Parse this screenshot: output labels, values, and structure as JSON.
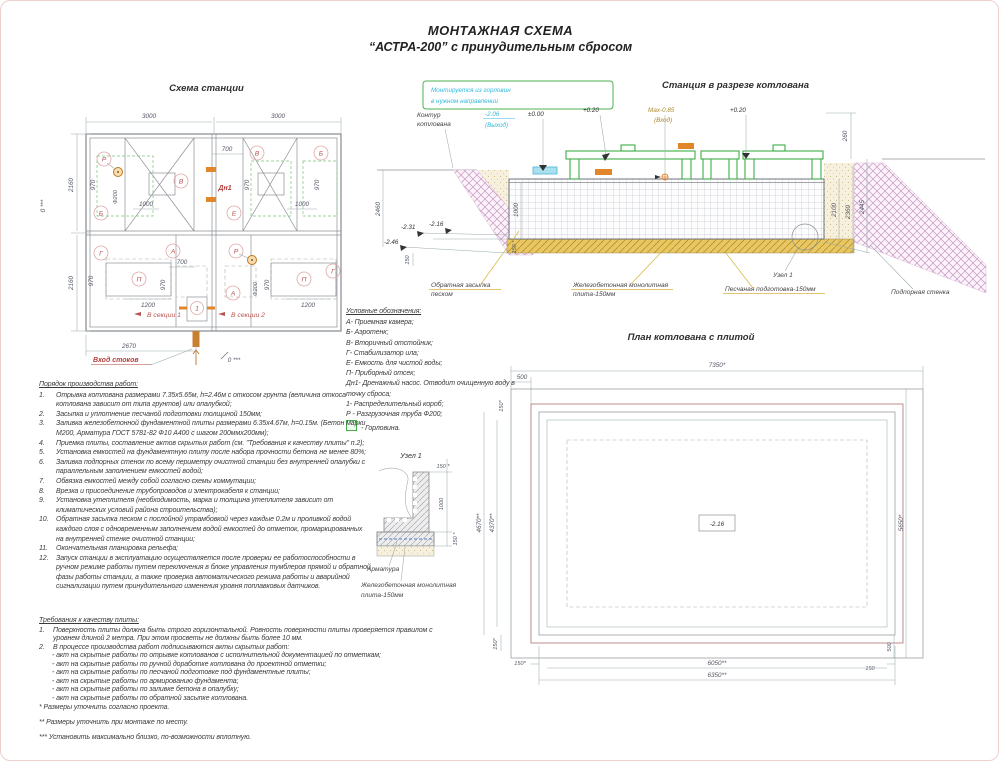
{
  "page": {
    "title1": "МОНТАЖНАЯ СХЕМА",
    "title2": "“АСТРА-200” с принудительным сбросом"
  },
  "colors": {
    "accent_green": "#3fae49",
    "accent_cyan": "#33b9dd",
    "accent_red": "#b85450",
    "hatch_pink": "#d2a0cc",
    "sand_yellow": "#e9c763",
    "orange": "#e2862a"
  },
  "plan": {
    "title": "Схема станции",
    "d3000": "3000",
    "d2160": "2160",
    "d700": "700",
    "d970": "970",
    "d1000": "1000",
    "d1200": "1200",
    "d2670": "2670",
    "f200": "Ф200",
    "zero": "0 ***",
    "lr": "Р",
    "lb": "Б",
    "lv": "В",
    "lg": "Г",
    "la": "А",
    "lp": "П",
    "le": "Е",
    "l1": "1",
    "ldn": "Дн1",
    "sec1": "В секции 1",
    "sec2": "В секции 2",
    "inlet": "Вход стоков"
  },
  "section": {
    "title": "Станция в разрезе котлована",
    "note1": "Монтируется из горловин",
    "note2": "в нужном направлении",
    "kontur1": "Контур",
    "kontur2": "котлована",
    "lvl_out": "-2.06",
    "lvl_out2": "(Выход)",
    "lvl_zero": "±0.00",
    "lvl_020": "+0.20",
    "lvl_max": "Мах-0.85",
    "lvl_max2": "(Вход)",
    "d260": "260",
    "d2100": "2100",
    "d2360": "2360",
    "d2445": "2445",
    "d2460": "2460",
    "m231": "-2.31",
    "m216": "-2.16",
    "m246": "-2.46",
    "d150": "150",
    "d1000": "1000",
    "d150s": "150 *",
    "backfill1": "Обратная засыпка",
    "backfill2": "песком",
    "plate1": "Железобетонная монолитная",
    "plate2": "плита-150мм",
    "sand": "Песчаная подготовка-150мм",
    "wall": "Подпорная стенка",
    "node": "Узел 1"
  },
  "legend": {
    "title": "Условные обозначения:",
    "items": [
      "А- Приемная камера;",
      "Б- Аэротенк;",
      "В- Вторичный отстойник;",
      "Г- Стабилизатор ила;",
      "Е- Емкость для чистой воды;",
      "П- Приборный отсек;",
      "Дн1- Дренажный насос. Отводит очищенную воду в точку сброса;",
      "1- Распределительный короб;",
      "Р - Разгрузочная труба Ф200;"
    ],
    "gorlovina": "- Горловина."
  },
  "work_order": {
    "title": "Порядок производства работ:",
    "items": [
      {
        "n": "1.",
        "t": "Отрывка котлована размерами 7.35х5.65м, h=2.46м с откосом грунта (величина откоса котлована зависит от типа грунтов) или опалубкой;"
      },
      {
        "n": "2.",
        "t": "Засыпка и уплотнение песчаной подготовки толщиной 150мм;"
      },
      {
        "n": "3.",
        "t": "Заливка железобетонной фундаментной плиты размерами 6.35х4.67м, h=0.15м. (Бетон марки М200, Арматура ГОСТ 5781-82 Ф10 А400 с шагом 200ммх200мм);"
      },
      {
        "n": "4.",
        "t": "Приемка плиты, составление актов скрытых работ (см. \"Требования к качеству плиты\" п.2);"
      },
      {
        "n": "5.",
        "t": "Установка емкостей на фундаментную плиту после набора прочности бетона не менее 80%;"
      },
      {
        "n": "6.",
        "t": "Заливка подпорных стенок по всему периметру очистной станции без внутренней опалубки с параллельным заполнением емкостей водой;"
      },
      {
        "n": "7.",
        "t": "Обвязка емкостей между собой согласно схемы коммутации;"
      },
      {
        "n": "8.",
        "t": "Врезка и присоединение трубопроводов и электрокабеля к станции;"
      },
      {
        "n": "9.",
        "t": "Установка утеплителя (необходимость, марка и толщина утеплителя зависит от климатических условий района строительства);"
      },
      {
        "n": "10.",
        "t": "Обратная засыпка песком с послойной утрамбовкой через каждые 0.2м и проливкой водой каждого слоя с одновременным заполнением водой емкостей до отметок, промаркированных на внутренней стенке очистной станции;"
      },
      {
        "n": "11.",
        "t": "Окончательная планировка рельефа;"
      },
      {
        "n": "12.",
        "t": "Запуск станции в эксплуатацию осуществляется после проверки ее работоспособности в ручном режиме работы путем переключения в блоке управления тумблеров прямой и обратной фазы работы станции, а также проверка автоматического режима работы и аварийной сигнализации путем принудительного изменения уровня поплавковых датчиков."
      }
    ]
  },
  "requirements": {
    "title": "Требования к качеству плиты:",
    "item1n": "1.",
    "item1": "Поверхность плиты должна быть строго горизонтальной. Ровность поверхности плиты проверяется правилом с уровнем длиной 2 метра. При этом просветы не должны быть более 10 мм.",
    "item2n": "2.",
    "item2": "В процессе производства работ подписываются акты скрытых работ:",
    "acts": [
      "- акт на скрытые работы по отрывке котлованов с исполнительной документацией по отметкам;",
      "- акт на скрытые работы по ручной доработке котлована до проектной отметки;",
      "- акт на скрытые работы по песчаной подготовке под фундаментные плиты;",
      "- акт на скрытые работы по армированию фундамента;",
      "- акт на скрытые работы по заливке бетона в опалубку;",
      "- акт на скрытые работы по обратной засыпке котлована."
    ]
  },
  "footnotes": [
    "* Размеры уточнить согласно проекта.",
    "** Размеры уточнить при монтаже по месту.",
    "*** Установить максимально близко, по-возможности вплотную."
  ],
  "pit_plan": {
    "title": "План котлована с плитой",
    "d7350": "7350*",
    "d500": "500",
    "d150s": "150*",
    "d4670": "4670**",
    "d4370": "4370**",
    "d5650": "5650*",
    "d150": "150",
    "d6050": "6050**",
    "d6350": "6350**",
    "level": "-2.16"
  },
  "node": {
    "title": "Узел 1",
    "d150": "150 *",
    "d1000": "1000",
    "arm": "Арматура",
    "plate1": "Железобетонная монолитная",
    "plate2": "плита-150мм"
  }
}
